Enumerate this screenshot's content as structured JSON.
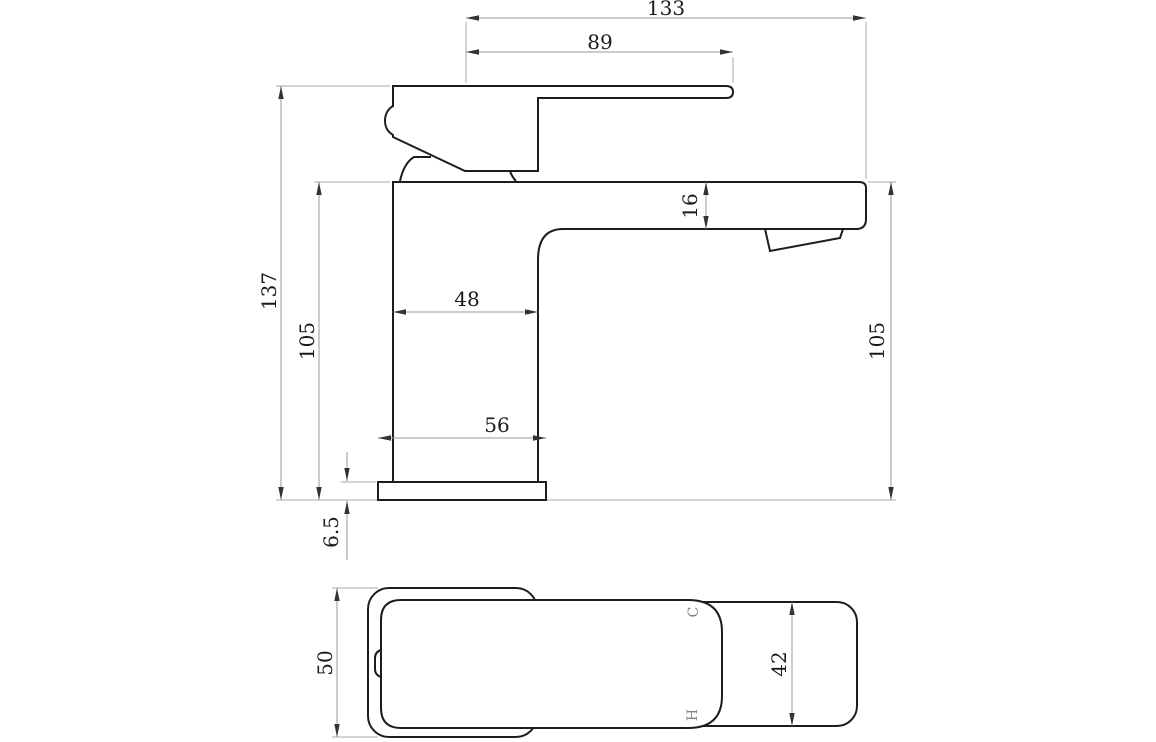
{
  "drawing": {
    "kind": "technical dimension drawing, faucet side elevation and plan view",
    "colors": {
      "background": "#ffffff",
      "outline": "#1d1d1d",
      "dimension_line": "#9a9a9a",
      "arrow": "#333333",
      "dimension_text": "#1a1a1a",
      "marking_text": "#828282"
    },
    "side_view": {
      "dims": {
        "overall_length": "133",
        "handle_reach": "89",
        "overall_height": "137",
        "height_left": "105",
        "height_right": "105",
        "spout_depth": "16",
        "body_width": "48",
        "base_width": "56",
        "base_thickness": "6.5"
      }
    },
    "plan_view": {
      "dims": {
        "body_depth": "50",
        "spout_width": "42"
      },
      "markings": {
        "cold": "C",
        "hot": "H"
      }
    }
  }
}
